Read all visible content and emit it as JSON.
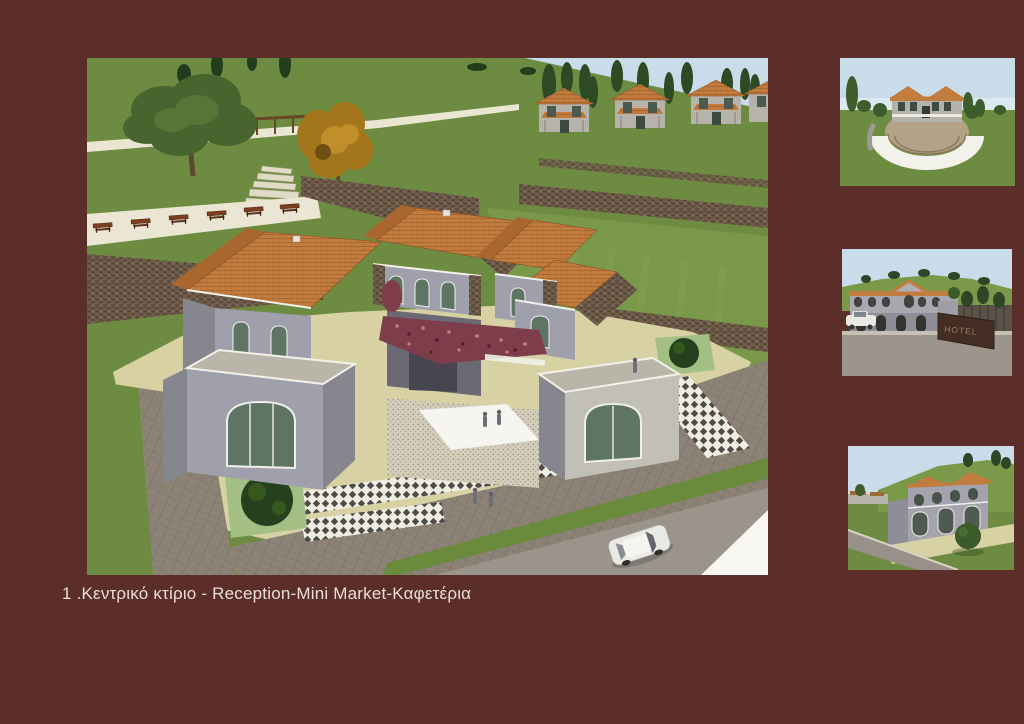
{
  "slide": {
    "caption": "1 .Κεντρικό κτίριο - Reception-Mini Market-Καφετέρια"
  },
  "images": {
    "main": {
      "label": "central-building-aerial-render"
    },
    "thumb1": {
      "label": "amphitheatre-rear-view-render"
    },
    "thumb2": {
      "label": "entrance-elevation-render",
      "sign_text": "HOTEL"
    },
    "thumb3": {
      "label": "street-perspective-render"
    }
  },
  "palette": {
    "bg": "#5C2E2A",
    "caption": "#EADDD7",
    "sky": "#C8DCEA",
    "grass": "#6E8C41",
    "grass_light": "#85A352",
    "road": "#8C8376",
    "plaza": "#D8D1A4",
    "path": "#EAE6D3",
    "roof": "#C17C3E",
    "stone": "#6E5B49",
    "wall": "#A0A0AC",
    "wall_shade": "#86868F",
    "glass": "#5E7565",
    "flower": "#7E3D4B",
    "white": "#F2F1EA"
  }
}
